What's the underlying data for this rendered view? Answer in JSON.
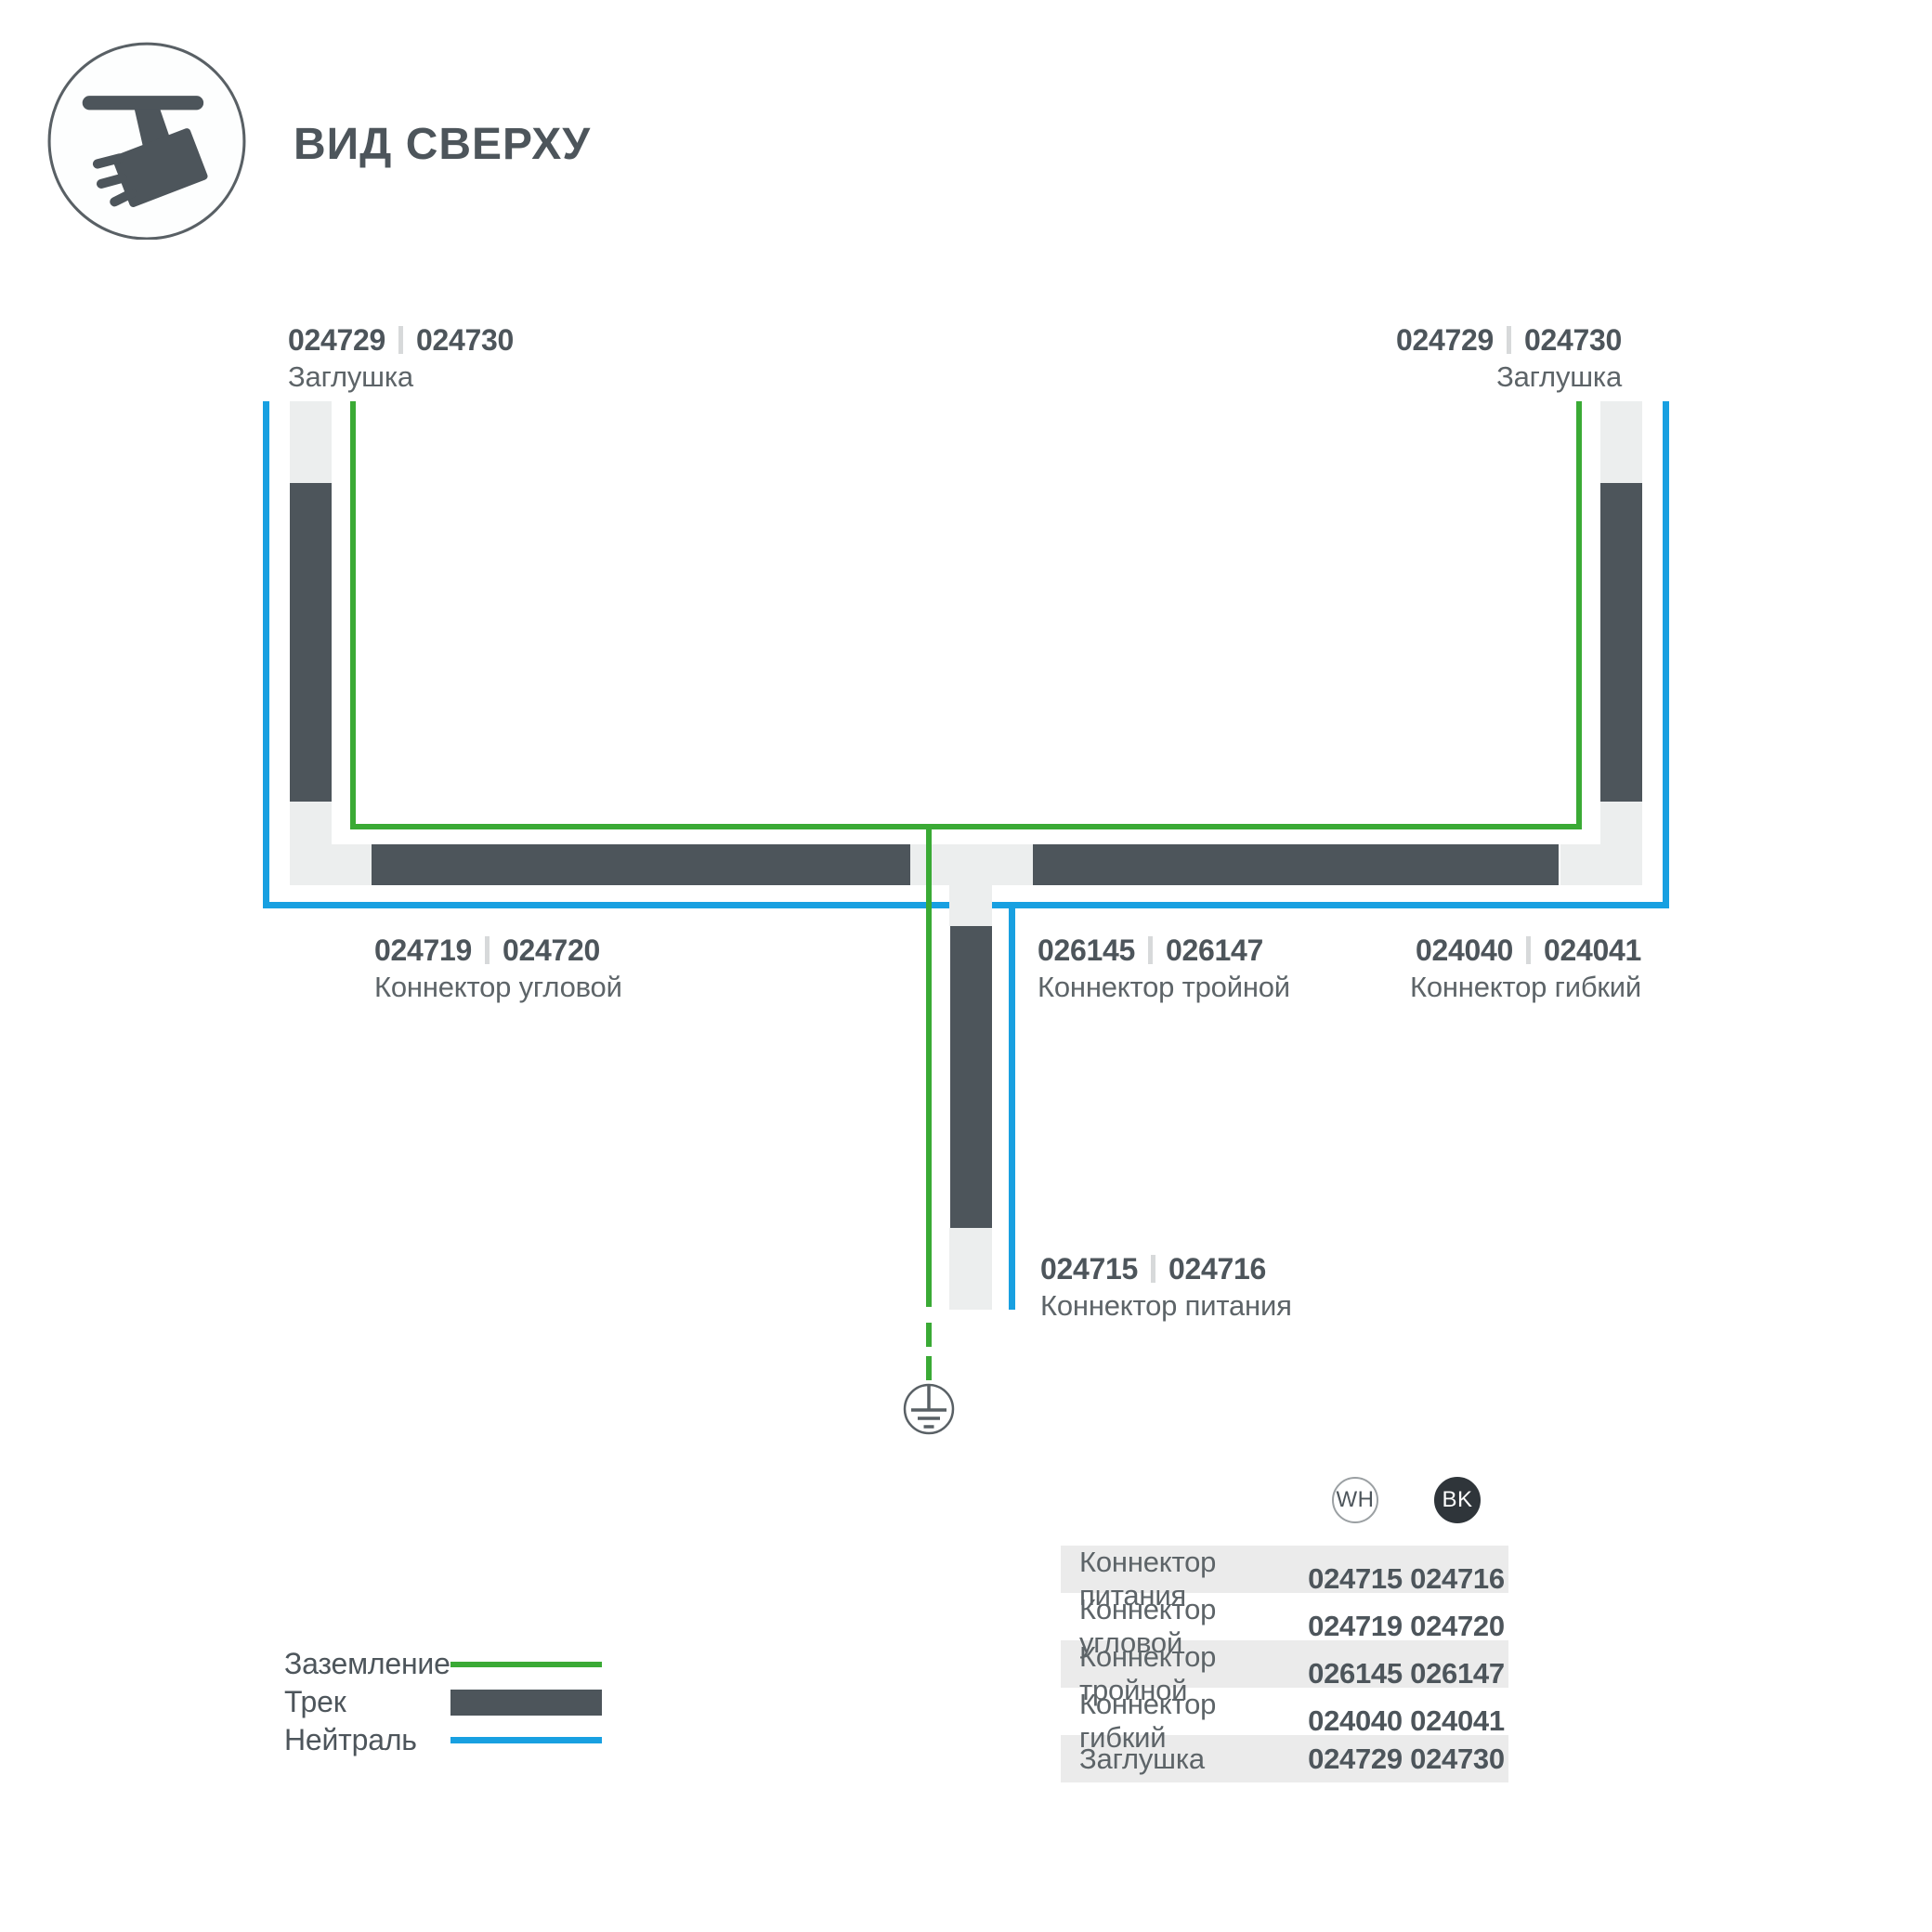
{
  "header": {
    "title": "ВИД СВЕРХУ"
  },
  "colors": {
    "track": "#4d555b",
    "ground": "#3aaa35",
    "neutral": "#18a0e1",
    "connector": "#eceeee",
    "text": "#4d555b",
    "text_secondary": "#5d6468",
    "separator": "#d7d9da",
    "row_alt": "#ebebeb",
    "bk_badge": "#2f353a",
    "circle_stroke": "#9ba0a3",
    "ground_stroke": "#596065"
  },
  "diagram": {
    "labels": {
      "endcap_left": {
        "code_wh": "024729",
        "code_bk": "024730",
        "name": "Заглушка"
      },
      "endcap_right": {
        "code_wh": "024729",
        "code_bk": "024730",
        "name": "Заглушка"
      },
      "corner": {
        "code_wh": "024719",
        "code_bk": "024720",
        "name": "Коннектор угловой"
      },
      "triple": {
        "code_wh": "026145",
        "code_bk": "026147",
        "name": "Коннектор тройной"
      },
      "flex": {
        "code_wh": "024040",
        "code_bk": "024041",
        "name": "Коннектор гибкий"
      },
      "power": {
        "code_wh": "024715",
        "code_bk": "024716",
        "name": "Коннектор питания"
      }
    }
  },
  "legend": {
    "items": [
      {
        "label": "Заземление"
      },
      {
        "label": "Трек"
      },
      {
        "label": "Нейтраль"
      }
    ]
  },
  "table": {
    "col_wh": "WH",
    "col_bk": "BK",
    "rows": [
      {
        "name": "Коннектор питания",
        "wh": "024715",
        "bk": "024716"
      },
      {
        "name": "Коннектор угловой",
        "wh": "024719",
        "bk": "024720"
      },
      {
        "name": "Коннектор тройной",
        "wh": "026145",
        "bk": "026147"
      },
      {
        "name": "Коннектор гибкий",
        "wh": "024040",
        "bk": "024041"
      },
      {
        "name": "Заглушка",
        "wh": "024729",
        "bk": "024730"
      }
    ]
  }
}
